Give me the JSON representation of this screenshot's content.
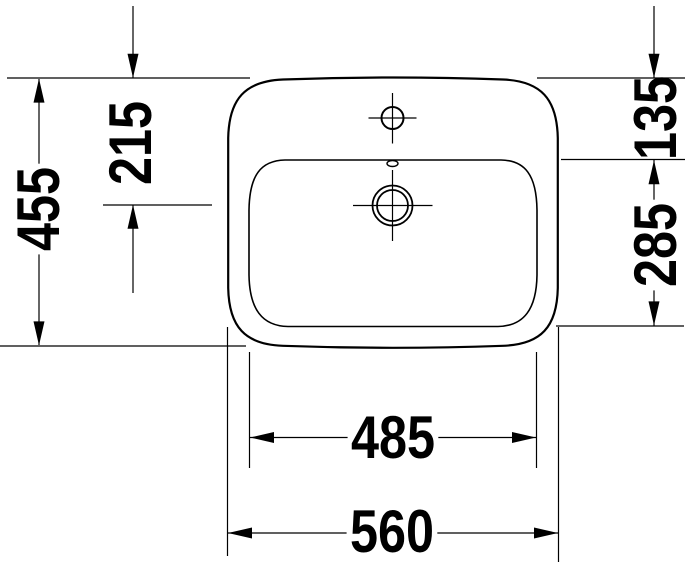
{
  "colors": {
    "line": "#000000",
    "background": "#ffffff"
  },
  "dimensions": {
    "overall_depth": "455",
    "drain_center_from_front": "215",
    "front_rim_to_bowl": "135",
    "bowl_depth": "285",
    "bowl_width": "485",
    "overall_width": "560"
  },
  "symbols": {
    "faucet_hole": "circle-with-crosshair",
    "overflow_slot": "small-oval",
    "drain": "double-circle-with-crosshair"
  }
}
